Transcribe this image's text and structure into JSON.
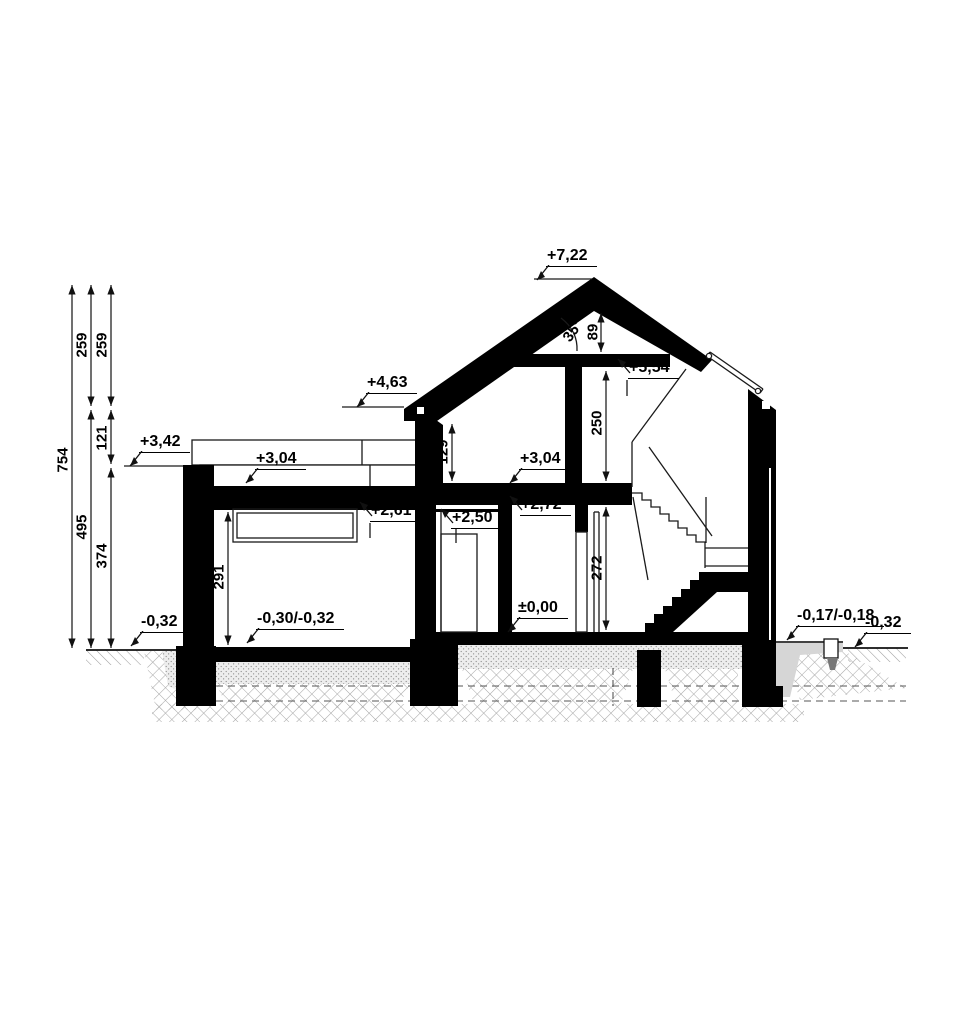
{
  "drawing": {
    "kind": "house cross-section",
    "colors": {
      "ink": "#000000",
      "outline": "#1a1a1a",
      "soil_hatch": "#a8a8a8",
      "bedding_dots": "#8f8f8f",
      "concrete": "#d6d6d6",
      "fixture": "#b7b7b7",
      "background": "#ffffff"
    }
  },
  "levels": {
    "ridge": "+7,22",
    "eaves": "+4,63",
    "garage_parapet": "+3,42",
    "garage_roof_slab": "+3,04",
    "attic_floor": "+3,04",
    "garage_window_top": "+2,61",
    "vestibule_ceiling": "+2,50",
    "hall_ceiling": "+2,72",
    "collar_ceiling": "+5,54",
    "ground_floor": "±0,00",
    "garage_floor": "-0,30/-0,32",
    "terrain_left": "-0,32",
    "terrace_right": "-0,17/-0,18",
    "terrain_right": "-0,32"
  },
  "dimension_chain": {
    "total_height": "754",
    "upper_left": "259",
    "lower_left": "495",
    "upper_right": "259",
    "middle_right": "121",
    "lower_right": "374"
  },
  "room_dimensions": {
    "garage_height": "291",
    "knee_wall_height": "129",
    "attic_room_height": "250",
    "ground_floor_height": "272",
    "ridge_to_collar": "89",
    "roof_pitch": "35°"
  }
}
